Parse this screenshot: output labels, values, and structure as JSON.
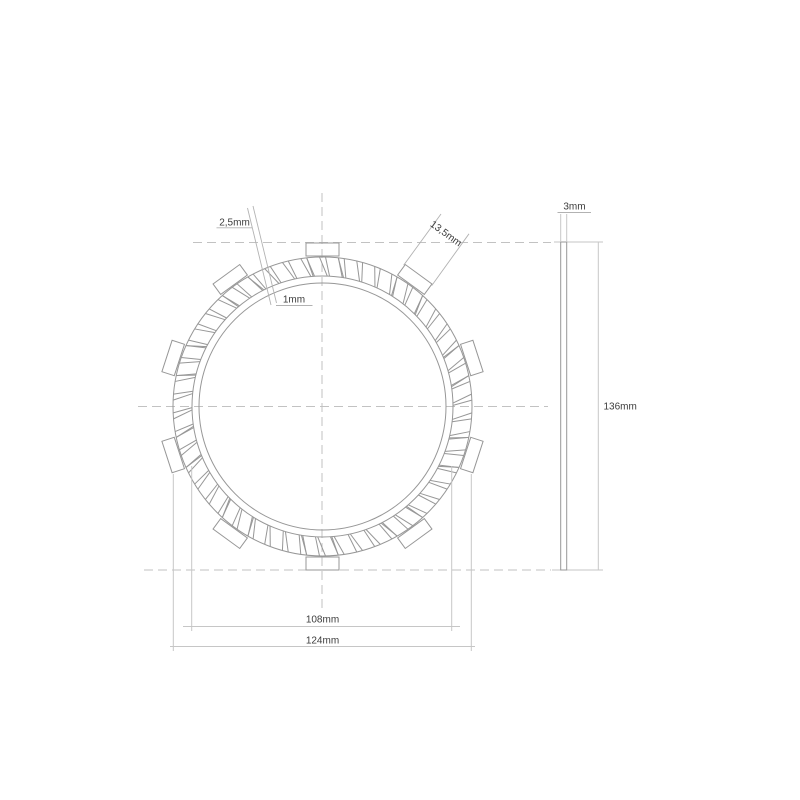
{
  "drawing": {
    "type": "clutch-friction-plate-technical-drawing",
    "views": {
      "front": "disc with friction pads and outer drive tabs",
      "side": "plate thickness profile"
    },
    "labels": {
      "groove_width_outer": "2,5mm",
      "groove_width_inner": "1mm",
      "tab_width": "13,5mm",
      "plate_thickness": "3mm",
      "overall_height": "136mm",
      "friction_outer_diameter": "108mm",
      "outer_diameter_over_tabs": "124mm"
    },
    "colors": {
      "background": "#ffffff",
      "geometry_line": "#979797",
      "centerline": "#c2c2c2",
      "dimension_line": "#c6c6c6",
      "leader_line": "#b2b2b2",
      "text": "#3c3c3c"
    },
    "geometry": {
      "center": {
        "x": 322.5,
        "y": 406.5
      },
      "circles_r": [
        123.5,
        130.5,
        149.5
      ],
      "grooves": {
        "count": 50,
        "start_deg": 90,
        "pitch_deg": -7.2,
        "outer_r": 149.5,
        "inner_r": 130.5,
        "outer_half_deg": 1.15,
        "inner_half_deg": 0.5,
        "inner_offset_deg": -2.6
      },
      "tabs": {
        "count": 10,
        "start_deg": 90,
        "pitch_deg": -36,
        "inner_r": 150.5,
        "outer_r": 163.5,
        "half_width_px": 16.5,
        "corner_half_deg": 6.1
      },
      "side_view": {
        "left": 560.7,
        "right": 566.7,
        "top": 242,
        "bottom": 570
      }
    }
  }
}
